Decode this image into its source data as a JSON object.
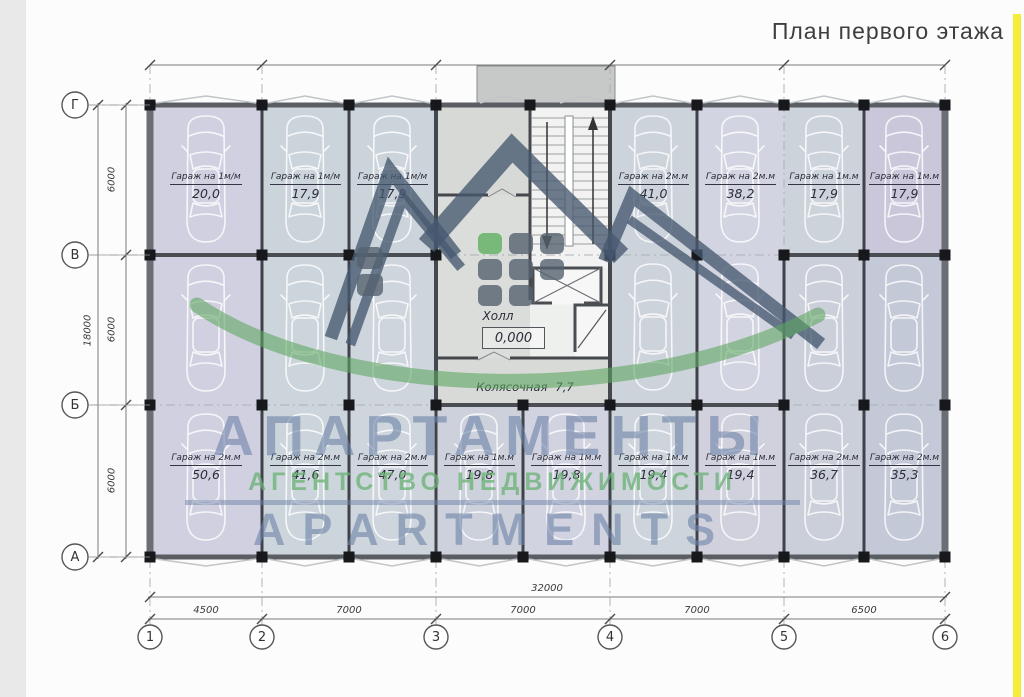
{
  "page": {
    "title": "План первого этажа"
  },
  "plan": {
    "rooms": {
      "hall": {
        "name": "Холл",
        "level": "0,000"
      },
      "stroller": {
        "name": "Колясочная",
        "area": "7,7"
      }
    },
    "garages": {
      "top": [
        {
          "label": "Гараж на 1м/м",
          "area": "20,0"
        },
        {
          "label": "Гараж на 1м/м",
          "area": "17,9"
        },
        {
          "label": "Гараж на 1м/м",
          "area": "17,9"
        },
        {
          "label": "Гараж на 2м.м",
          "area": "41,0"
        },
        {
          "label": "Гараж на 2м.м",
          "area": "38,2"
        },
        {
          "label": "Гараж на 1м.м",
          "area": "17,9"
        },
        {
          "label": "Гараж на 1м.м",
          "area": "17,9"
        }
      ],
      "bottom": [
        {
          "label": "Гараж на 2м.м",
          "area": "50,6"
        },
        {
          "label": "Гараж на 2м.м",
          "area": "41,6"
        },
        {
          "label": "Гараж на 2м.м",
          "area": "47,0"
        },
        {
          "label": "Гараж на 1м.м",
          "area": "19,8"
        },
        {
          "label": "Гараж на 1м.м",
          "area": "19,8"
        },
        {
          "label": "Гараж на 1м.м",
          "area": "19,4"
        },
        {
          "label": "Гараж на 1м.м",
          "area": "19,4"
        },
        {
          "label": "Гараж на 2м.м",
          "area": "36,7"
        },
        {
          "label": "Гараж на 2м.м",
          "area": "35,3"
        }
      ]
    },
    "axes": {
      "horizontal": [
        "Г",
        "В",
        "Б",
        "А"
      ],
      "vertical": [
        "1",
        "2",
        "3",
        "4",
        "5",
        "6"
      ]
    },
    "dimensions": {
      "left_total": "18000",
      "left_segments": [
        "6000",
        "6000",
        "6000"
      ],
      "bottom_total": "32000",
      "bottom_segments": [
        "4500",
        "7000",
        "7000",
        "7000",
        "6500"
      ]
    }
  },
  "watermark": {
    "line1": "АПАРТАМЕНТЫ",
    "line2": "АГЕНТСТВО  НЕДВИЖИМОСТИ",
    "line3": "APARTMENTS"
  },
  "colors": {
    "accent_yellow": "#f6ed38",
    "watermark_blue": "#6d82a7",
    "watermark_green": "#68b073",
    "logo_navy": "#46586f",
    "wall": "#54575c"
  }
}
